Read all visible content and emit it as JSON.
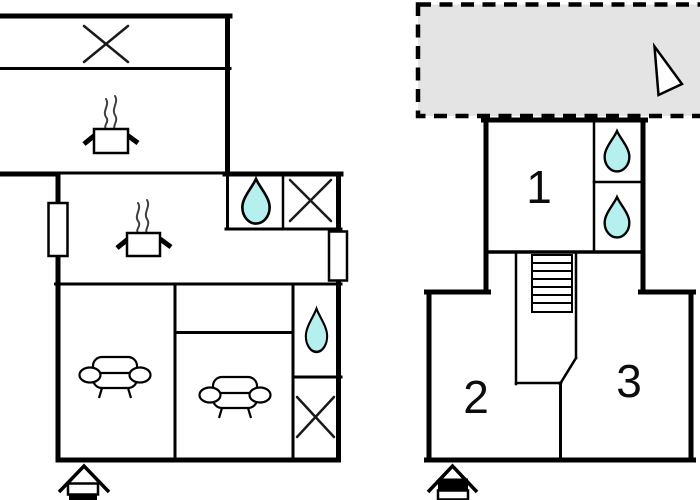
{
  "canvas": {
    "width": 700,
    "height": 500,
    "background": "#ffffff"
  },
  "colors": {
    "wall": "#000000",
    "water_drop_fill": "#b5efee",
    "terrace_fill": "#e4e4e4",
    "steam": "#3f3f3f",
    "label_text": "#0c0c0c"
  },
  "right_unit": {
    "room_labels": [
      "1",
      "2",
      "3"
    ]
  },
  "icons": {
    "water_drop": "water-drop",
    "window_cross": "window-cross",
    "hotplate": "hotplate-with-steam",
    "sofa": "sofa",
    "stairs": "staircase",
    "entrance": "house-entrance",
    "north_arrow": "north-arrow",
    "terrace": "dashed-terrace",
    "window": "wall-window"
  }
}
